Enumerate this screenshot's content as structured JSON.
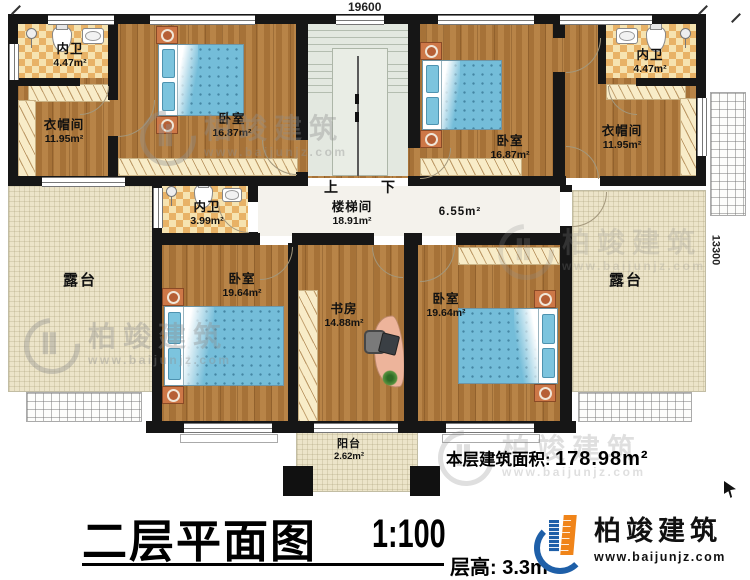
{
  "drawing": {
    "title": "二层平面图",
    "scale": "1:100",
    "floor_height_label": "层高:",
    "floor_height_value": "3.3m",
    "floor_area_label": "本层建筑面积:",
    "floor_area_value": "178.98m²"
  },
  "dimensions": {
    "top_width": "19600",
    "right_height": "13300"
  },
  "stairs": {
    "up": "上",
    "down": "下"
  },
  "brand": {
    "name": "柏竣建筑",
    "website": "www.baijunjz.com"
  },
  "rooms": {
    "bath_top_left": {
      "name": "内卫",
      "area": "4.47m²"
    },
    "cloak_left": {
      "name": "衣帽间",
      "area": "11.95m²"
    },
    "bedroom_top_left": {
      "name": "卧室",
      "area": "16.87m²"
    },
    "stairwell": {
      "name": "楼梯间",
      "area": "18.91m²"
    },
    "bedroom_top_right": {
      "name": "卧室",
      "area": "16.87m²"
    },
    "bath_top_right": {
      "name": "内卫",
      "area": "4.47m²"
    },
    "cloak_right": {
      "name": "衣帽间",
      "area": "11.95m²"
    },
    "bath_middle": {
      "name": "内卫",
      "area": "3.99m²"
    },
    "hallway": {
      "area": "6.55m²"
    },
    "bedroom_bottom_left": {
      "name": "卧室",
      "area": "19.64m²"
    },
    "study": {
      "name": "书房",
      "area": "14.88m²"
    },
    "bedroom_bottom_right": {
      "name": "卧室",
      "area": "19.64m²"
    },
    "terrace_left": {
      "name": "露台"
    },
    "terrace_right": {
      "name": "露台"
    },
    "balcony": {
      "name": "阳台",
      "area": "2.62m²"
    }
  },
  "colors": {
    "wall": "#161616",
    "wood_floor": "#b0793b",
    "tile_accent": "#e8b266",
    "terrace": "#ece4c9",
    "stair": "#e3e8e0",
    "bed": "#74bdd9",
    "logo_blue": "#1e5fa8",
    "logo_orange": "#f08419"
  }
}
